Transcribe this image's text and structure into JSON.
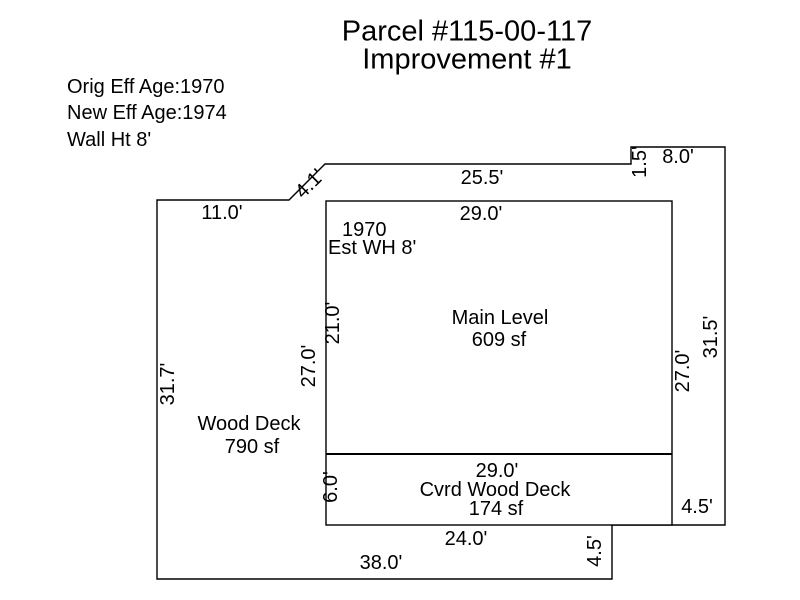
{
  "title": {
    "line1": "Parcel #115-00-117",
    "line2": "Improvement #1"
  },
  "info": {
    "lines": [
      "Orig Eff Age:1970",
      "New Eff Age:1974",
      "Wall Ht 8'"
    ]
  },
  "areas": {
    "main_level": {
      "year": "1970",
      "est_wall_height": "Est WH 8'",
      "name": "Main Level",
      "area": "609 sf"
    },
    "wood_deck": {
      "name": "Wood Deck",
      "area": "790 sf"
    },
    "cvrd_wood_deck": {
      "name": "Cvrd Wood Deck",
      "area": "174 sf"
    }
  },
  "dims": {
    "outer_top_left": "11.0'",
    "diagonal": "4.1'",
    "outer_top": "25.5'",
    "notch_height": "1.5'",
    "notch_width": "8.0'",
    "main_top": "29.0'",
    "main_left": "21.0'",
    "inner_left_total": "27.0'",
    "inner_right_total": "27.0'",
    "outer_left": "31.7'",
    "outer_right": "31.5'",
    "right_strip": "4.5'",
    "cvrd_left": "6.0'",
    "cvrd_top": "29.0'",
    "cvrd_bottom": "24.0'",
    "bottom_step": "4.5'",
    "outer_bottom": "38.0'"
  },
  "colors": {
    "background": "#ffffff",
    "line": "#000000",
    "text": "#000000"
  }
}
